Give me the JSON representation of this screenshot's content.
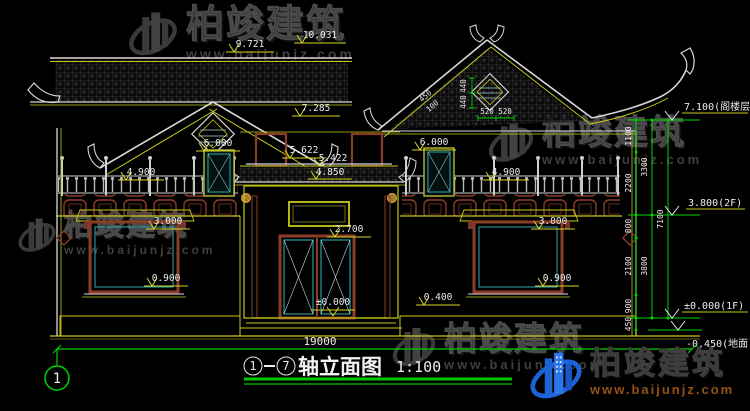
{
  "watermark": {
    "brand": "柏竣建筑",
    "url": "www.baijunjz.com"
  },
  "footer_logo": {
    "brand": "柏竣建筑",
    "url": "www.baijunjz.com"
  },
  "title_bar": {
    "axis_from": "1",
    "axis_to": "7",
    "name": "轴立面图",
    "scale": "1:100"
  },
  "axis_bubble": "1",
  "dims": {
    "ridge_left": "9.721",
    "ridge_right": "10.031",
    "eave_mid": "7.285",
    "balcony_door_left": "6.000",
    "balcony_door_right": "6.000",
    "railing_left": "4.900",
    "railing_right": "4.900",
    "canopy_a": "5.622",
    "canopy_b": "5.422",
    "canopy_c": "4.850",
    "window_left_head": "3.000",
    "window_right_head": "3.000",
    "window_left_sill": "0.900",
    "window_right_sill": "0.900",
    "door_head": "2.700",
    "threshold": "±0.000",
    "plinth": "0.400",
    "overall_width": "19000"
  },
  "gable_dims": {
    "v1": "440",
    "v2": "440",
    "h1": "520",
    "h2": "520",
    "s1": "450",
    "s2": "100"
  },
  "levels": [
    "7.100(阁楼层)",
    "3.800(2F)",
    "±0.000(1F)",
    "-0.450(地面)"
  ],
  "chain": {
    "seg1100": "1100",
    "seg2200": "2200",
    "tot3300": "3300",
    "seg800": "800",
    "seg2100": "2100",
    "seg900": "900",
    "seg450": "450",
    "tot3800": "3800",
    "tot7100": "7100"
  },
  "colors": {
    "line_yellow": "#c8c81e",
    "line_white": "#e8e8e8",
    "dim_green": "#00d200",
    "lattice_teal": "#2fa8a8",
    "frame_red": "#8a3c28",
    "logo_blue": "#1d63d8",
    "logo_orange": "#94520f"
  }
}
